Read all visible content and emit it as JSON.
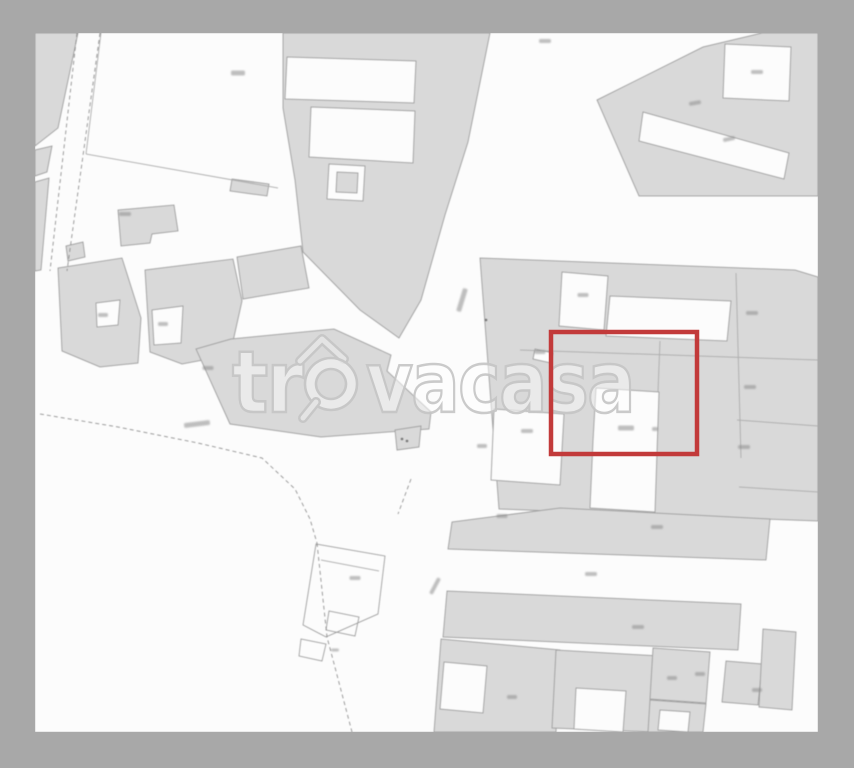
{
  "watermark": {
    "prefix": "tr",
    "suffix": "vacasa",
    "stroke_color": "#c6c6c6",
    "fill_color": "rgba(255,255,255,0.5)"
  },
  "highlight": {
    "x": 551,
    "y": 332,
    "w": 146,
    "h": 122,
    "color": "#c23a3a",
    "stroke_width": 4.5
  },
  "map": {
    "frame": "#a8a8a8",
    "bg": "#fcfcfc",
    "fill": "#d9d9d9",
    "stroke": "#a0a0a0",
    "line": "#aeaeae",
    "dash": "#8f8f8f",
    "smudge": "#8d8d8d",
    "inner": {
      "x": 35,
      "y": 33,
      "w": 783,
      "h": 699
    }
  },
  "geometry": {
    "buildings": [
      "35,33 78,33 58,128 35,146",
      "35,150 52,146 47,172 35,176",
      "35,182 49,178 41,270 35,271",
      "118,210 174,205 178,231 152,234 150,243 121,246",
      "66,246 83,242 85,257 68,261",
      "58,268 122,258 141,318 138,363 100,367 62,351",
      "145,270 233,259 242,301 230,355 182,364 150,352",
      "237,257 301,246 309,288 243,299",
      "232,179 269,184 267,196 230,191",
      "283,33 490,33 468,142 445,215 421,300 399,338 360,310 303,252 295,180 283,108",
      "196,349 231,339 334,329 391,355 387,371 431,412 429,429 321,437 230,424",
      "395,430 421,426 419,447 397,450",
      "597,100 703,47 762,33 818,33 818,196 639,196",
      "480,258 795,270 818,277 818,521 499,509",
      "452,522 560,508 770,519 766,560 448,549",
      "447,591 741,604 738,650 443,637",
      "441,639 560,650 556,732 434,732",
      "556,650 660,656 655,732 552,728",
      "653,648 710,652 706,703 650,699",
      "726,661 762,664 758,705 722,702",
      "763,629 796,632 792,710 759,707",
      "650,700 706,704 703,732 648,732"
    ],
    "whites": [
      "287,57 416,61 414,103 285,99",
      "311,107 415,111 413,163 309,157",
      "329,164 365,166 363,201 327,199",
      "725,44 791,47 789,101 723,98",
      "643,112 789,153 784,179 639,141",
      "562,272 608,276 604,330 559,326",
      "610,296 731,301 727,341 606,336",
      "596,388 659,392 655,512 590,508 593,441",
      "494,409 564,414 560,485 491,480",
      "535,349 553,353 551,363 533,359",
      "96,303 120,300 118,325 97,327",
      "152,310 183,306 181,343 154,345",
      "444,662 487,666 483,713 440,709",
      "576,688 626,691 623,732 574,729",
      "660,710 690,712 688,732 658,730"
    ],
    "insets": [
      "337,172 358,173 357,193 336,192"
    ],
    "outlines": [
      "316,544 385,556 378,614 326,637 303,625",
      "329,611 359,617 355,636 326,630",
      "301,639 326,644 322,661 299,656"
    ],
    "lines": [
      "101,33 86,154",
      "86,154 278,188",
      "520,350 818,360",
      "736,273 741,458",
      "737,420 818,426",
      "739,487 818,492",
      "321,560 379,571",
      "660,341 658,392"
    ],
    "dashes": [
      "77,33 50,271",
      "100,33 67,271",
      "40,414 118,427 198,443 262,458 295,489 310,519 317,543",
      "317,543 327,637 352,732",
      "411,479 398,514"
    ],
    "labels": [
      [
        238,
        73,
        14,
        5,
        0
      ],
      [
        125,
        214,
        12,
        4,
        0
      ],
      [
        545,
        41,
        12,
        4,
        0
      ],
      [
        757,
        72,
        12,
        4,
        0
      ],
      [
        695,
        103,
        12,
        4,
        -10
      ],
      [
        729,
        139,
        12,
        4,
        -12
      ],
      [
        103,
        315,
        10,
        4,
        0
      ],
      [
        163,
        324,
        10,
        4,
        0
      ],
      [
        208,
        368,
        11,
        4,
        0
      ],
      [
        197,
        424,
        26,
        5,
        -7
      ],
      [
        462,
        300,
        24,
        5,
        -73
      ],
      [
        583,
        295,
        11,
        4,
        0
      ],
      [
        540,
        352,
        11,
        4,
        0
      ],
      [
        626,
        428,
        16,
        5,
        0
      ],
      [
        655,
        429,
        6,
        4,
        0
      ],
      [
        752,
        313,
        12,
        4,
        0
      ],
      [
        750,
        387,
        12,
        4,
        0
      ],
      [
        744,
        447,
        12,
        4,
        0
      ],
      [
        527,
        431,
        12,
        4,
        0
      ],
      [
        482,
        446,
        10,
        4,
        0
      ],
      [
        502,
        516,
        11,
        4,
        0
      ],
      [
        657,
        527,
        12,
        4,
        0
      ],
      [
        591,
        574,
        12,
        4,
        0
      ],
      [
        638,
        627,
        12,
        4,
        0
      ],
      [
        435,
        586,
        18,
        4,
        -62
      ],
      [
        355,
        578,
        11,
        4,
        0
      ],
      [
        335,
        650,
        8,
        3,
        0
      ],
      [
        512,
        697,
        10,
        4,
        0
      ],
      [
        672,
        678,
        10,
        4,
        0
      ],
      [
        700,
        674,
        10,
        4,
        0
      ],
      [
        757,
        690,
        10,
        4,
        0
      ]
    ],
    "dots": [
      [
        402,
        439
      ],
      [
        407,
        441
      ],
      [
        486,
        320
      ]
    ]
  }
}
